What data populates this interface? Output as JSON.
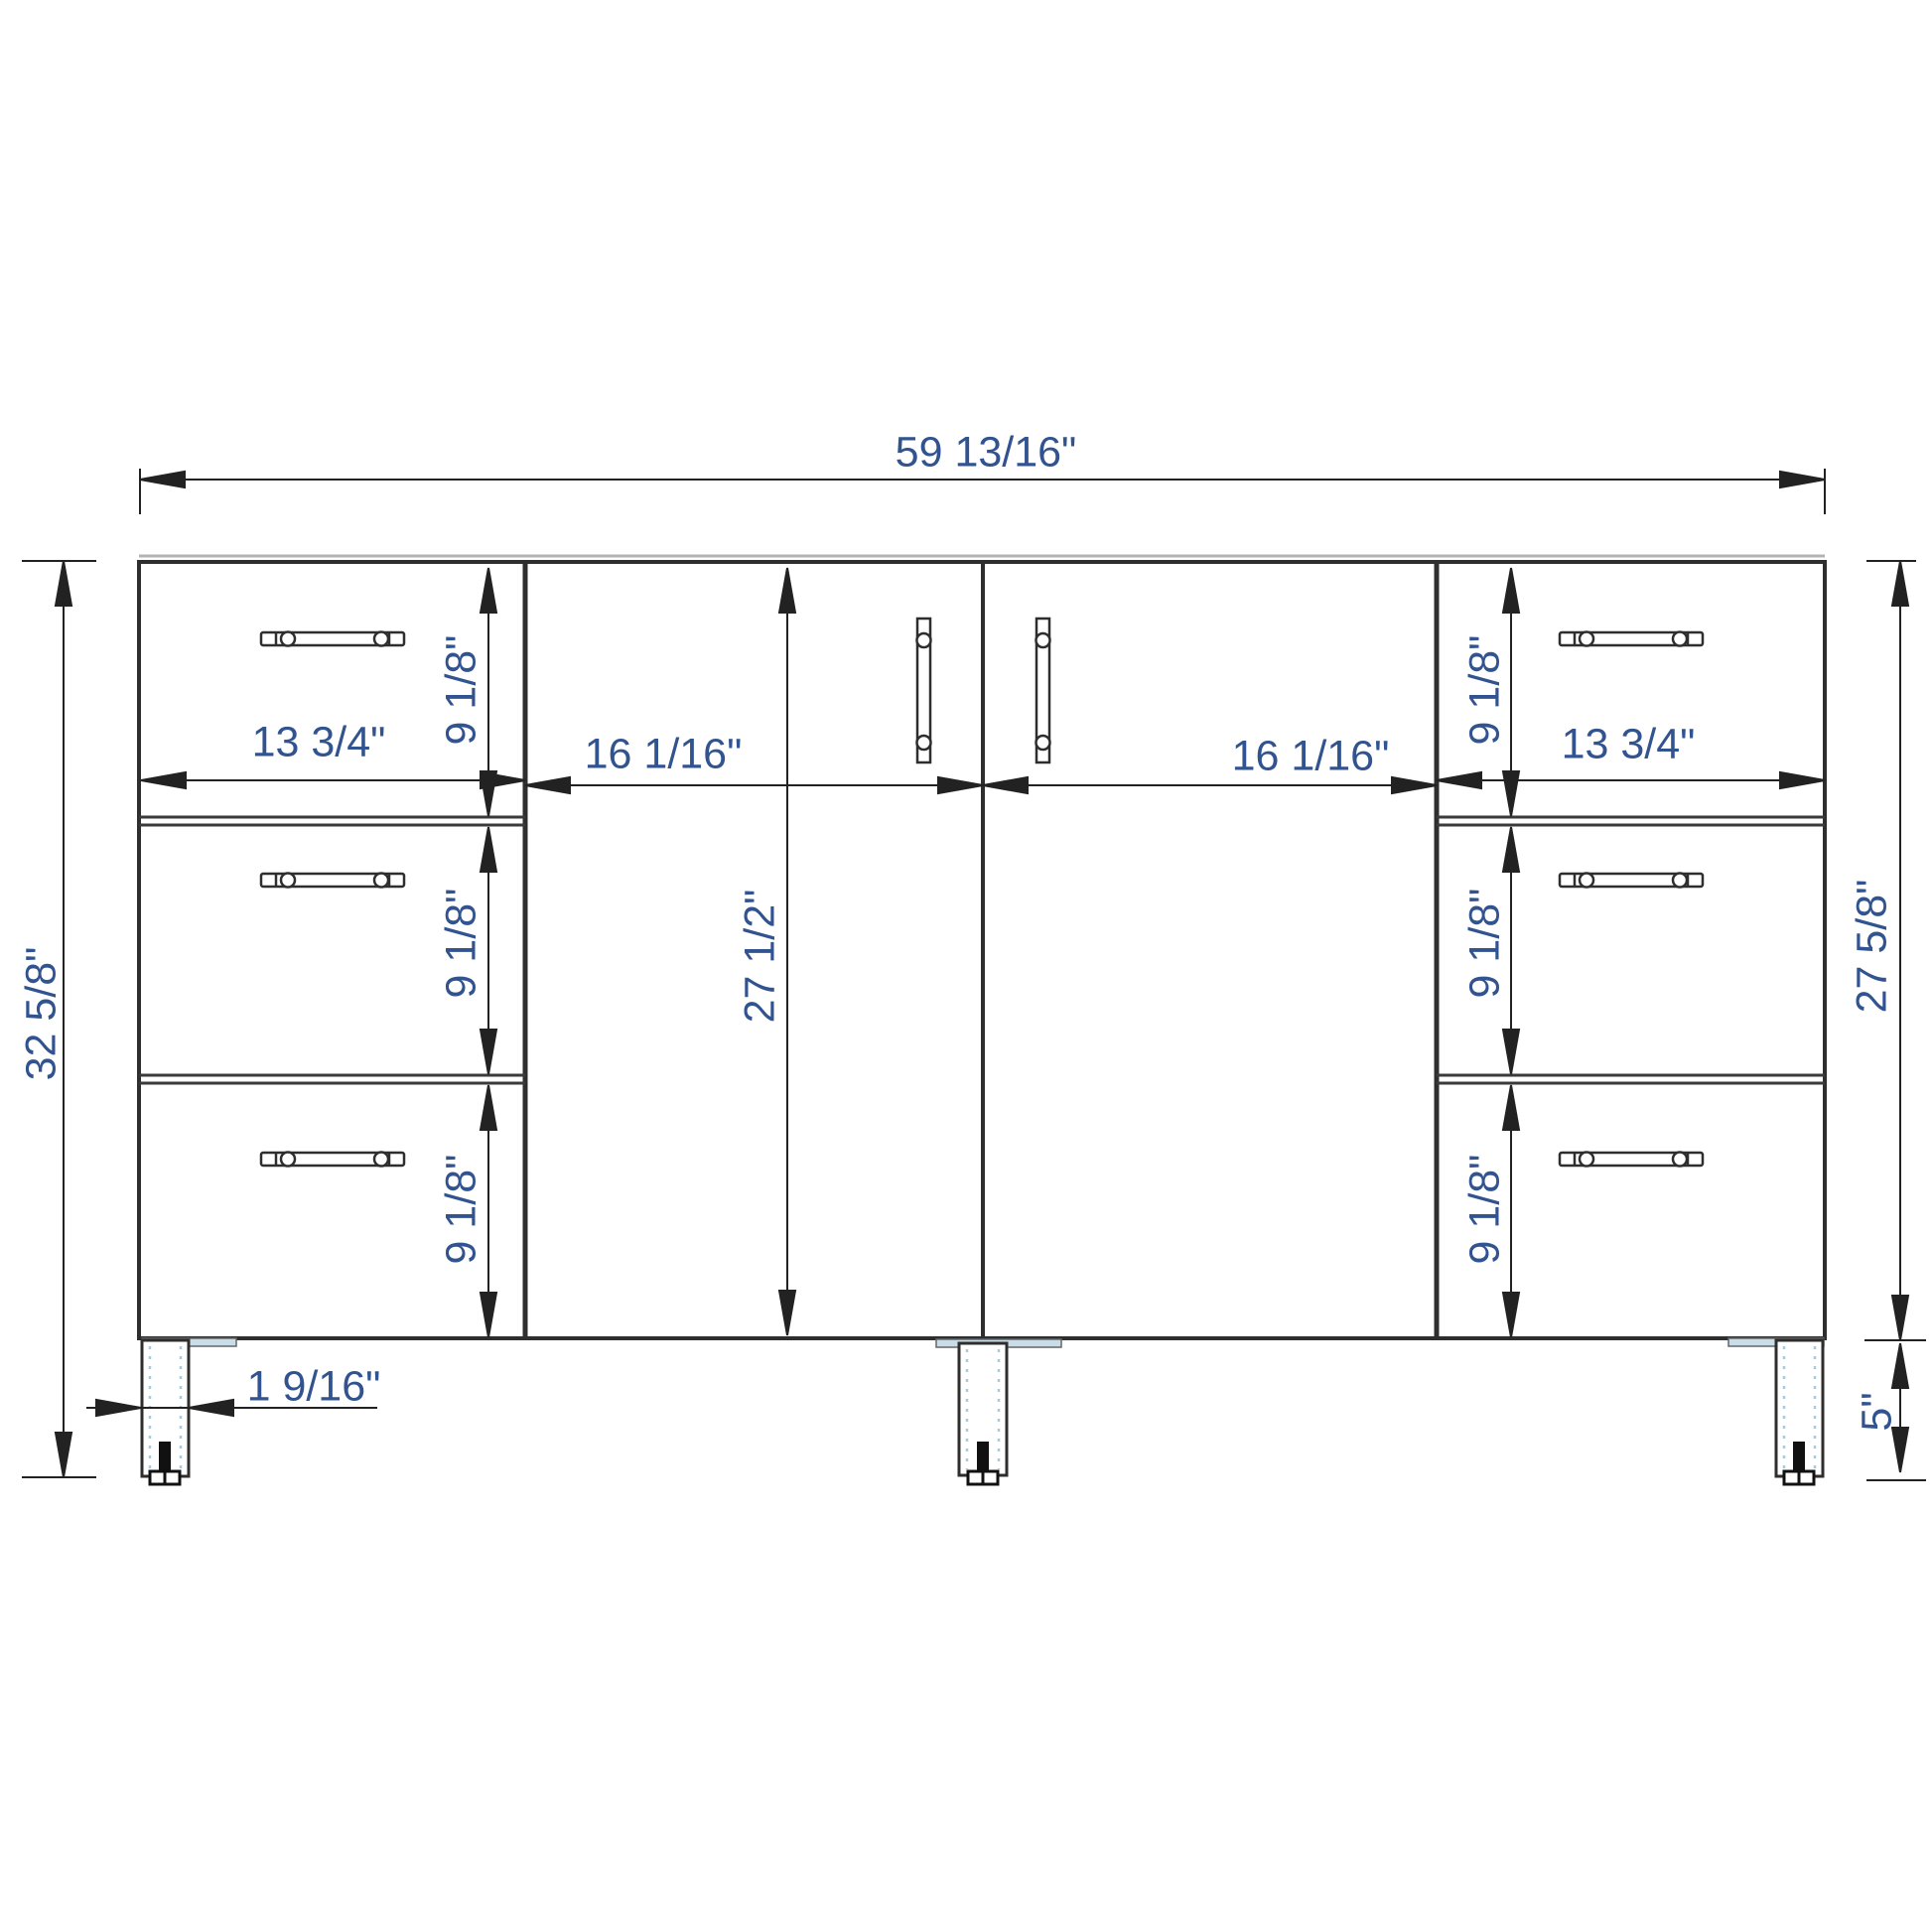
{
  "drawing": {
    "type": "cabinet-front-elevation-dimension-drawing",
    "colors": {
      "dimension_text": "#31538f",
      "line": "#2e2e2e",
      "leg_plate_tint": "#c9dde9",
      "leg_dash_tint": "#a9c9de"
    },
    "labels": {
      "overall_width": "59 13/16\"",
      "total_height": "32 5/8\"",
      "cabinet_body_height": "27 5/8\"",
      "door_height": "27 1/2\"",
      "leg_height": "5\"",
      "leg_offset": "1 9/16\"",
      "left_drawer_width": "13 3/4\"",
      "right_drawer_width": "13 3/4\"",
      "left_door_width": "16 1/16\"",
      "right_door_width": "16 1/16\"",
      "left_drawer1_height": "9 1/8\"",
      "left_drawer2_height": "9 1/8\"",
      "left_drawer3_height": "9 1/8\"",
      "right_drawer1_height": "9 1/8\"",
      "right_drawer2_height": "9 1/8\"",
      "right_drawer3_height": "9 1/8\""
    },
    "structure": {
      "left_drawer_count": 3,
      "right_drawer_count": 3,
      "door_count": 2,
      "leg_count": 3
    }
  }
}
